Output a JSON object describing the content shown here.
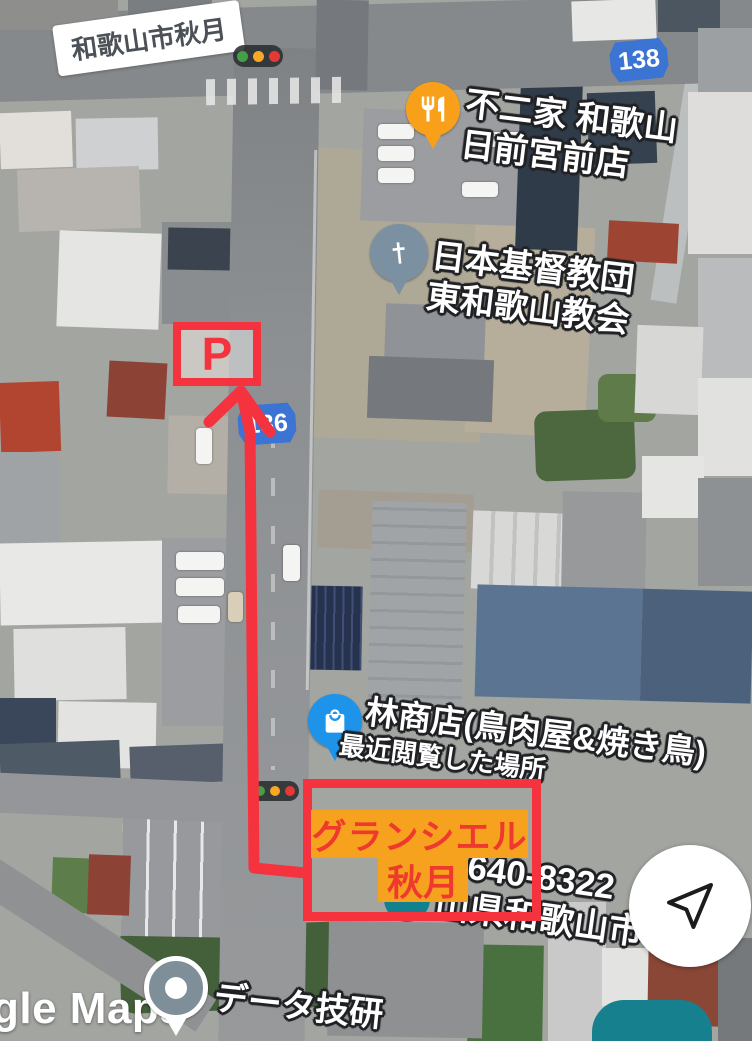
{
  "colors": {
    "route_red": "#f5333f",
    "shield_blue": "#3b74d2",
    "highlight_orange_bg": "#f6a21e",
    "highlight_red_text": "#ef392f",
    "restaurant_pin_orange": "#f9a01b",
    "church_pin_slate": "#7b91a2",
    "shopping_pin_blue": "#1d93ea",
    "generic_pin_gray": "#7e8f99",
    "recent_place_pin_teal": "#12818f",
    "fab_teal": "#17808e",
    "traffic_light_green": "#43a047",
    "traffic_light_amber": "#f9a825",
    "traffic_light_red": "#e53935"
  },
  "area_label": {
    "text": "和歌山市秋月"
  },
  "route_shields": {
    "shield_138": "138",
    "shield_136": "136"
  },
  "pois": {
    "restaurant": {
      "line1": "不二家 和歌山",
      "line2": "日前宮前店"
    },
    "church": {
      "line1": "日本基督教団",
      "line2": "東和歌山教会"
    },
    "shop": {
      "name": "林商店(鳥肉屋&焼き鳥)",
      "subtitle": "最近閲覧した場所"
    },
    "office": {
      "name": "データ技研"
    }
  },
  "annotations": {
    "parking_label": "P",
    "destination_line1": "グランシエル",
    "destination_line2": "秋月"
  },
  "address": {
    "postal_code": "〒640-8322",
    "city": "山県和歌山市"
  },
  "watermark": {
    "text": "gle Maps"
  }
}
